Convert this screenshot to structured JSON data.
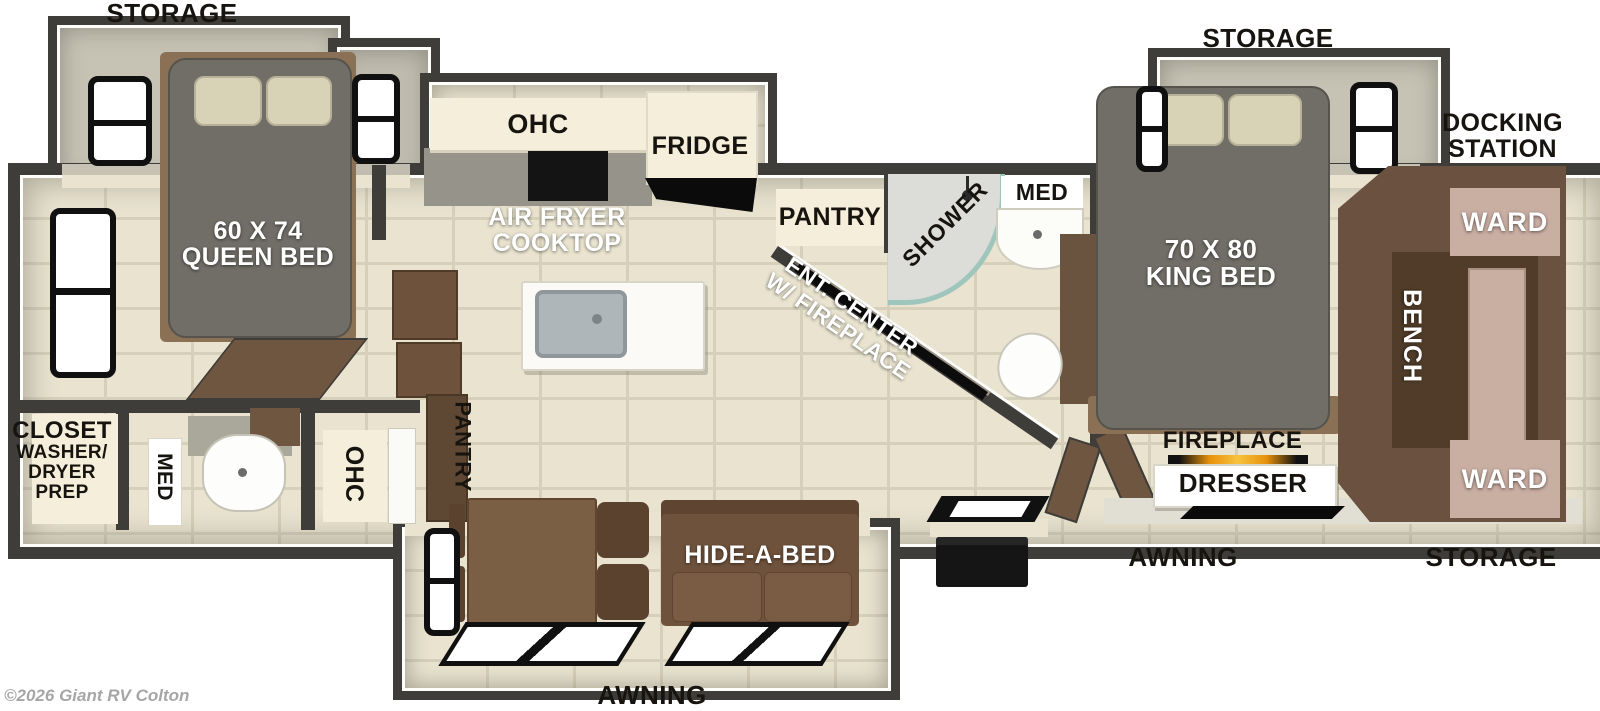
{
  "labels": {
    "storage_front": "STORAGE",
    "storage_rear_top": "STORAGE",
    "docking_line1": "DOCKING",
    "docking_line2": "STATION",
    "awning_rear": "AWNING",
    "storage_rear_bottom": "STORAGE",
    "awning_main": "AWNING",
    "watermark": "©2026 Giant RV Colton"
  },
  "front_bedroom": {
    "bed_size": "60 X 74",
    "bed_type": "QUEEN BED",
    "closet": "CLOSET",
    "washer_line1": "WASHER/",
    "washer_line2": "DRYER",
    "washer_line3": "PREP",
    "med": "MED",
    "ohc": "OHC"
  },
  "kitchen": {
    "ohc": "OHC",
    "fridge": "FRIDGE",
    "cooktop_line1": "AIR FRYER",
    "cooktop_line2": "COOKTOP",
    "pantry": "PANTRY",
    "pantry_tall": "PANTRY"
  },
  "living": {
    "hide_a_bed": "HIDE-A-BED",
    "ent_line1": "ENT. CENTER",
    "ent_line2": "W/ FIREPLACE"
  },
  "bathroom": {
    "shower": "SHOWER",
    "med": "MED"
  },
  "rear_bedroom": {
    "bed_size": "70 X 80",
    "bed_type": "KING BED",
    "ward_top": "WARD",
    "bench": "BENCH",
    "ward_bottom": "WARD",
    "fireplace": "FIREPLACE",
    "dresser": "DRESSER"
  },
  "colors": {
    "wall": "#3f3d39",
    "tile": "#e9e3cf",
    "carpet": "#c6c3b5",
    "wood": "#6f523c",
    "cabinet_cream": "#f4eedb",
    "ward_tan": "#c9aea2"
  }
}
